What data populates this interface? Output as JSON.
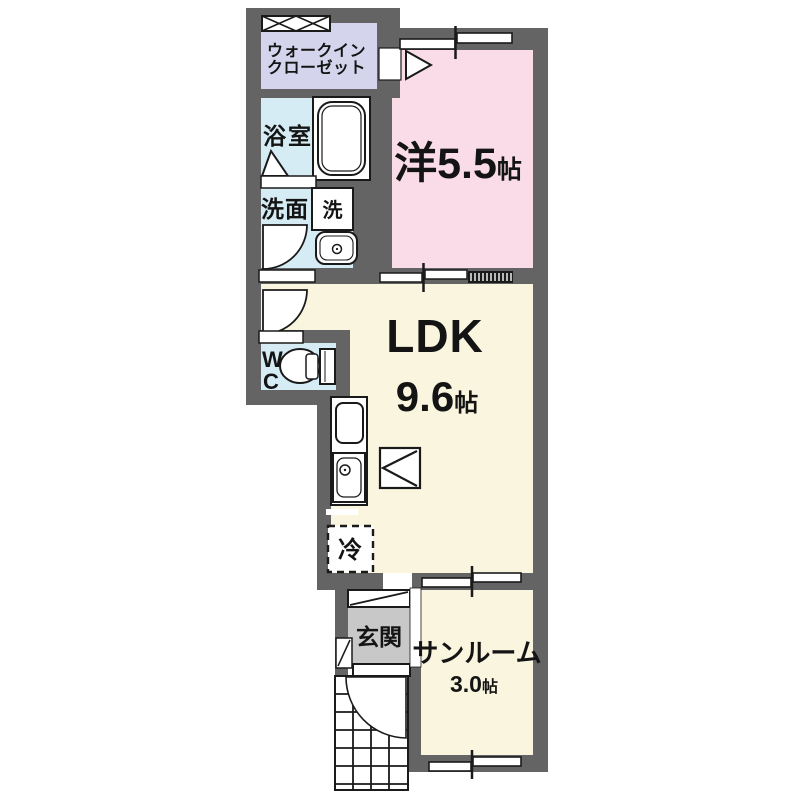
{
  "colors": {
    "wall": "#646464",
    "closet_floor": "#d4d4ec",
    "wet_floor": "#d6ecf4",
    "bedroom_floor": "#f9dce7",
    "ldk_floor": "#faf5de",
    "entrance_floor": "#c8c8c8",
    "line": "#1a1a1a"
  },
  "rooms": {
    "walk_in_closet": {
      "line1": "ウォークイン",
      "line2": "クローゼット"
    },
    "bathroom": {
      "label": "浴室"
    },
    "washroom": {
      "label": "洗面"
    },
    "washer": {
      "label": "洗"
    },
    "western_room": {
      "label": "洋5.5",
      "unit": "帖"
    },
    "ldk": {
      "label": "LDK",
      "size": "9.6",
      "unit": "帖"
    },
    "wc": {
      "line1": "W",
      "line2": "C"
    },
    "refrigerator": {
      "label": "冷"
    },
    "entrance": {
      "label": "玄関"
    },
    "sunroom": {
      "label": "サンルーム",
      "size": "3.0",
      "unit": "帖"
    }
  }
}
